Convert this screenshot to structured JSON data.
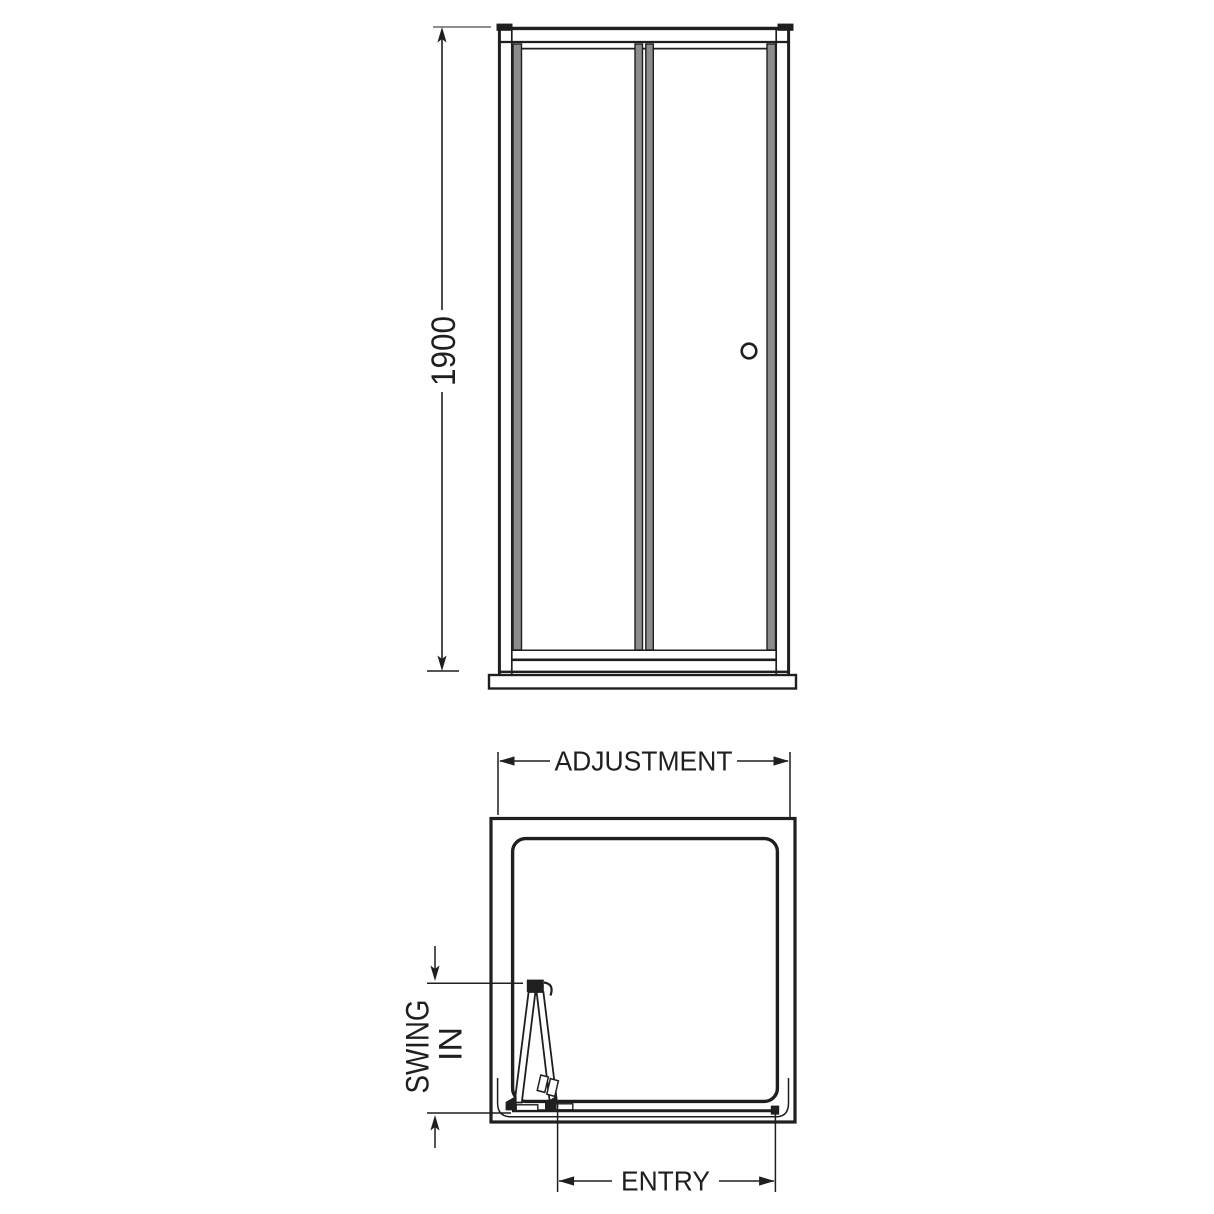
{
  "front_view": {
    "height_dimension_label": "1900"
  },
  "plan_view": {
    "adjustment_dimension_label": "ADJUSTMENT",
    "swing_dimension_label_line1": "SWING",
    "swing_dimension_label_line2": "IN",
    "entry_dimension_label": "ENTRY"
  },
  "colors": {
    "line_black": "#1f1f1f",
    "profile_gray": "#8c8c8c",
    "extension_gray": "#8f8f8f",
    "background": "#ffffff"
  }
}
